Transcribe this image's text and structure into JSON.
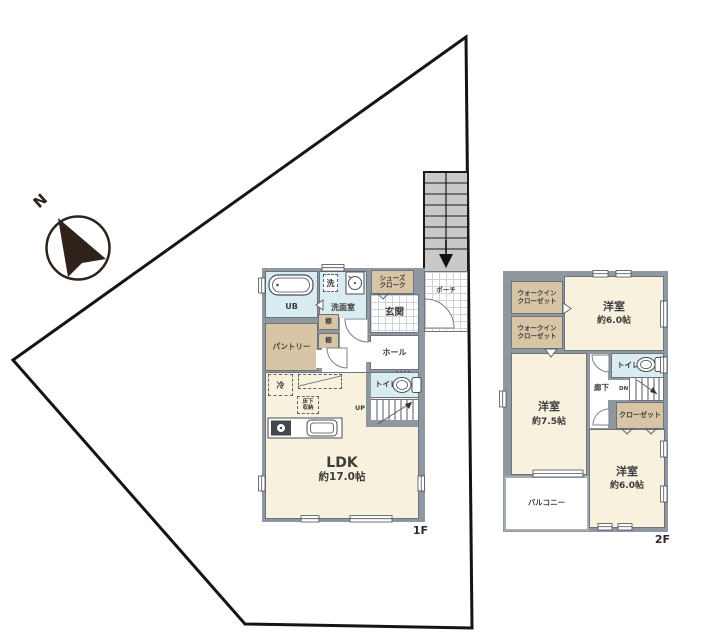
{
  "compass": {
    "north_label": "N"
  },
  "floor1": {
    "floor_label": "1F",
    "ub": "UB",
    "washer": "洗",
    "washroom": "洗面室",
    "shoes_line1": "シューズ",
    "shoes_line2": "クローク",
    "genkan": "玄関",
    "porch": "ポーチ",
    "hall": "ホール",
    "pantry": "パントリー",
    "shelf": "棚",
    "fridge": "冷",
    "underfloor_line1": "床下",
    "underfloor_line2": "収納",
    "toilet": "トイレ",
    "up": "UP",
    "ldk": "LDK",
    "ldk_size": "約17.0帖"
  },
  "floor2": {
    "floor_label": "2F",
    "wic_line1": "ウォークイン",
    "wic_line2": "クローゼット",
    "bedroom": "洋室",
    "bedroom_top_size": "約6.0帖",
    "bedroom_left_size": "約7.5帖",
    "bedroom_bottom_size": "約6.0帖",
    "toilet": "トイレ",
    "hallway": "廊下",
    "down": "DN",
    "closet": "クローゼット",
    "balcony": "バルコニー"
  },
  "colors": {
    "wall": "#8f97a0",
    "room_cream": "#f8f1dd",
    "room_tan": "#d8c5a5",
    "room_blue": "#d9ecf2",
    "tile_line": "#cdd3d8",
    "exterior_stairs": "#c9c9c9",
    "site_boundary": "#141414",
    "compass": "#2f221b"
  }
}
